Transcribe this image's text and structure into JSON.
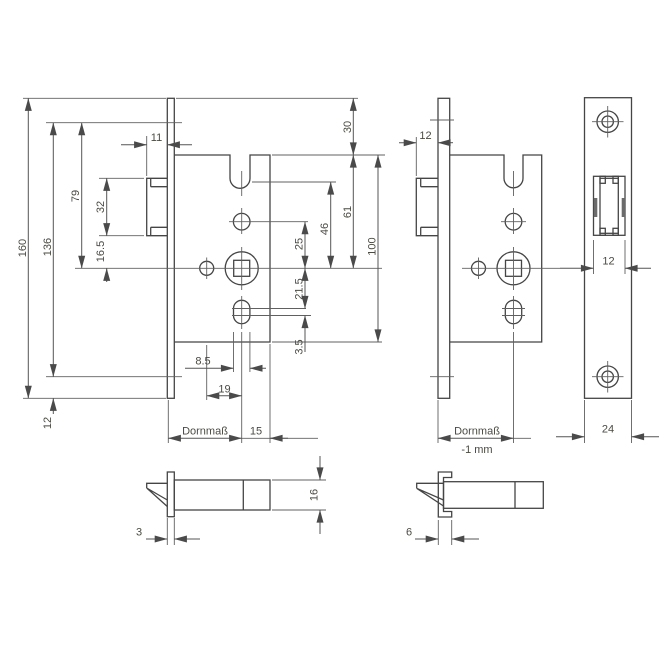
{
  "colors": {
    "background": "#ffffff",
    "object_line": "#454545",
    "dimension_line": "#555555",
    "label_text": "#4b4a42",
    "latch_shade": "#6b6b6b"
  },
  "views": {
    "lock_side_left": {
      "dims": {
        "height_total": "160",
        "screw_spacing": "136",
        "top_screw_to_spindle": "79",
        "latch_height": "32",
        "latch_bottom_to_spindle": "16.5",
        "bottom_screw_to_plate_end": "12",
        "latch_projection": "11",
        "plate_top_to_case": "30",
        "case_top_to_spindle": "61",
        "case_height": "100",
        "latch_axis_to_spindle": "46",
        "hole_to_spindle": "25",
        "spindle_to_slot": "21.5",
        "slot_centers": "3.5",
        "slot_width": "8.5",
        "hub_to_spindle": "19",
        "backset_label": "Dornmaß",
        "spindle_to_case_back": "15"
      }
    },
    "lock_side_middle": {
      "dims": {
        "latch_projection": "12",
        "backset_label": "Dornmaß",
        "backset_offset": "-1 mm"
      }
    },
    "faceplate_front": {
      "dims": {
        "latch_cutout_width": "12",
        "plate_width": "24"
      }
    },
    "latch_detail_flat": {
      "dims": {
        "plate_thickness": "3",
        "latch_thickness": "16"
      }
    },
    "latch_detail_channel": {
      "dims": {
        "plate_depth": "6"
      }
    }
  }
}
